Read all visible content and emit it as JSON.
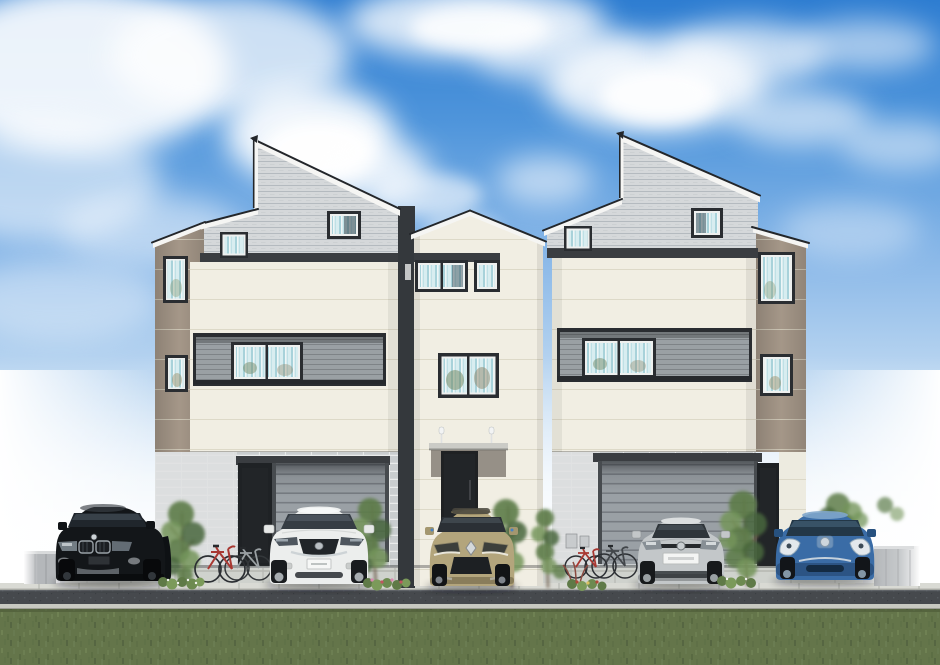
{
  "scene": {
    "description": "Architectural rendering of three modern three-story townhouses with slanted gable roofs, recessed balconies, garages, five parked cars, four bicycles, small trees and flower beds, a sidewalk, a road and a lawn under a blue sky with white clouds",
    "houses": [
      {
        "id": "left-house",
        "stories": 3,
        "features": [
          "gray slanted gable",
          "secondary gable",
          "taupe side wing",
          "recessed balcony",
          "garage",
          "entry door"
        ]
      },
      {
        "id": "middle-house",
        "stories": 3,
        "features": [
          "cream gable",
          "entry canopy with twin posts",
          "entry door",
          "porch step"
        ]
      },
      {
        "id": "right-house",
        "stories": 3,
        "features": [
          "gray slanted gable",
          "secondary gable",
          "taupe side wing",
          "recessed balcony",
          "garage",
          "entry door",
          "meter boxes"
        ]
      }
    ],
    "vehicles": [
      {
        "id": "black-suv",
        "body": "SUV",
        "color_hex": "#131619"
      },
      {
        "id": "white-crossover",
        "body": "crossover",
        "color_hex": "#eceeed"
      },
      {
        "id": "gold-hatchback",
        "body": "hatchback",
        "color_hex": "#b3a57c"
      },
      {
        "id": "silver-coupe",
        "body": "coupe",
        "color_hex": "#c3c7c9"
      },
      {
        "id": "blue-hatchback",
        "body": "hatchback",
        "color_hex": "#3a6ca6"
      }
    ],
    "bicycles": [
      {
        "id": "silver-bicycle-left"
      },
      {
        "id": "red-bicycle-left"
      },
      {
        "id": "red-bicycle-right"
      },
      {
        "id": "dark-bicycle-right"
      }
    ],
    "landscape": {
      "trees": 6,
      "flower_beds": 4,
      "lawn": true,
      "road": true,
      "sidewalk": true,
      "boundary_walls": 2
    }
  },
  "palette": {
    "skyTop": "#2e7dd1",
    "cream": "#f1eee3",
    "gableGray": "#d5d8da",
    "taupe": "#a89a8b",
    "fascia": "#f5f5f3",
    "roofEdge": "#23262a",
    "band": "#3a3d41",
    "frame": "#2a2d31",
    "sash": "#eef0ef",
    "balcony": "#9aa0a4",
    "brick": "#c9cdcf",
    "brickLight": "#dfe1e2",
    "garage": "#9aa0a5",
    "doorDark": "#222528",
    "sideWall": "#34383c",
    "paver": "#cfd2cd",
    "curb": "#d9dad4",
    "road": "#46494d",
    "grass": "#64754a",
    "treeB": "#5d7c49",
    "trunk": "#6b5947",
    "carBlack": "#131619",
    "carWhite": "#eceeed",
    "carGold": "#b3a57c",
    "carSilver": "#c3c7c9",
    "carBlue": "#3a6ca6",
    "bikeRed": "#a83832",
    "bikeSilver": "#9aa0a3",
    "bikeDark": "#42464a",
    "wallGray": "#b4b7ba",
    "cloud": "#ffffff"
  }
}
